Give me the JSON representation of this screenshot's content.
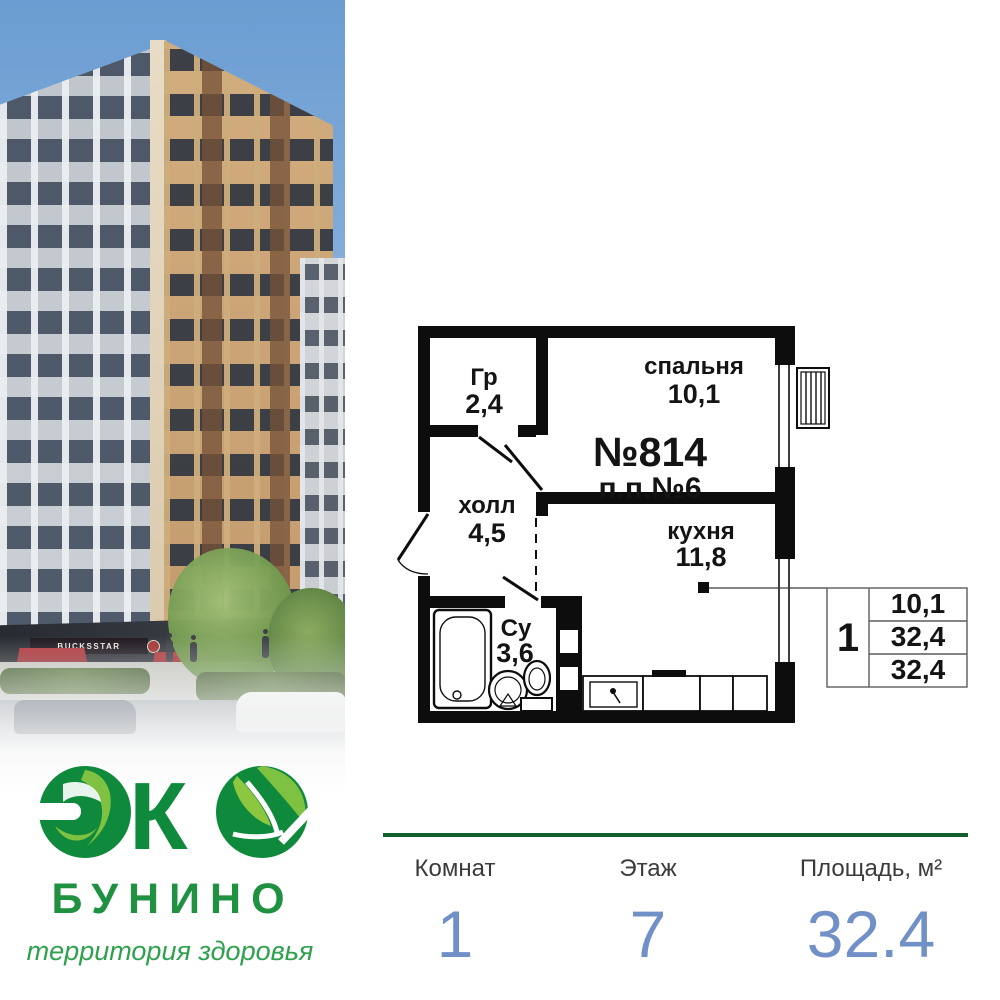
{
  "photo": {
    "storefront_sign": "BUCKSSTAR"
  },
  "logo": {
    "mark": "ЭКО",
    "mark_k": "К",
    "brand_name": "БУНИНО",
    "tagline": "территория здоровья",
    "colors": {
      "dark_green": "#0f8a3c",
      "light_green": "#7fc241",
      "text_green": "#1f9140"
    }
  },
  "floor_plan": {
    "apartment_number": "№814",
    "pp_number": "п.п.№6",
    "rooms": [
      {
        "name": "Гр",
        "area": "2,4"
      },
      {
        "name": "спальня",
        "area": "10,1"
      },
      {
        "name": "холл",
        "area": "4,5"
      },
      {
        "name": "кухня",
        "area": "11,8"
      },
      {
        "name": "Су",
        "area": "3,6"
      }
    ],
    "summary_table": {
      "rooms_count": "1",
      "rows": [
        "10,1",
        "32,4",
        "32,4"
      ]
    }
  },
  "stats": {
    "divider_color": "#135f2b",
    "value_color": "#7190c7",
    "items": [
      {
        "label": "Комнат",
        "value": "1"
      },
      {
        "label": "Этаж",
        "value": "7"
      },
      {
        "label": "Площадь, м²",
        "value": "32.4"
      }
    ]
  }
}
